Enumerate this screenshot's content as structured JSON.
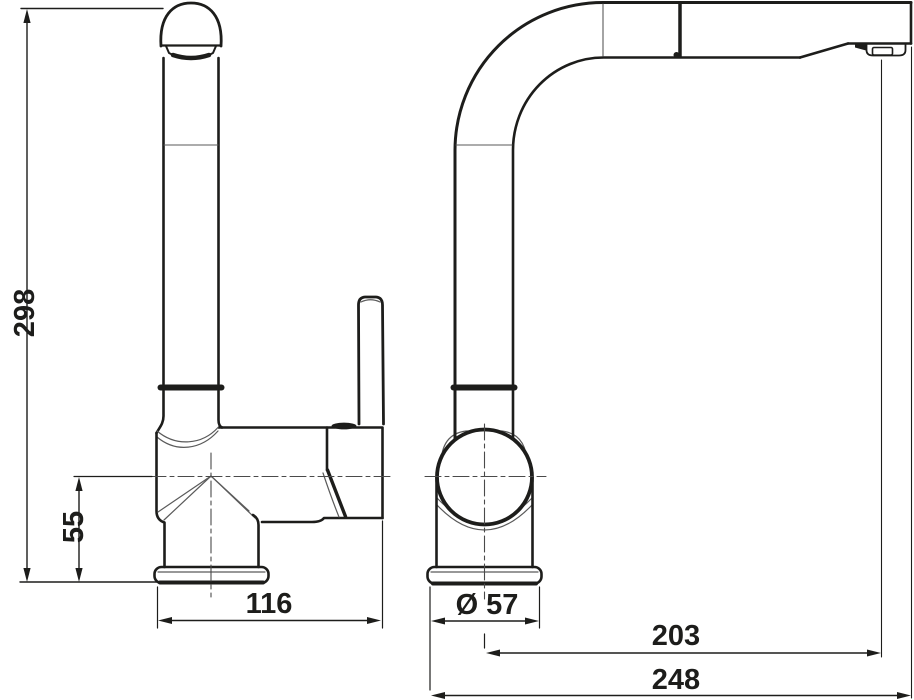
{
  "drawing": {
    "background_color": "#ffffff",
    "line_color": "#1d1d1b",
    "views": {
      "front_view": "faucet-front-elevation",
      "side_view": "faucet-side-elevation"
    },
    "dimensions": {
      "overall_height": "298",
      "base_to_spout_axis_height": "55",
      "body_depth": "116",
      "base_diameter": "Ø 57",
      "spout_reach": "203",
      "overall_depth": "248"
    }
  }
}
